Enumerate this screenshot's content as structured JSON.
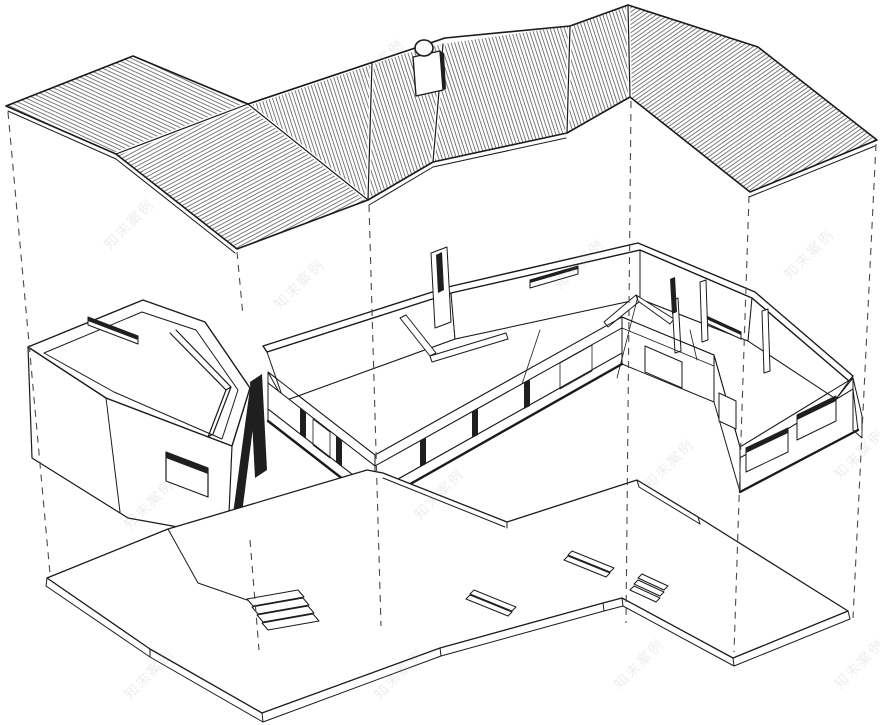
{
  "meta": {
    "description": "Exploded axonometric line drawing of an angled single-storey house: folded roof plate, floor-plan level and ground slab linked by dashed projection lines",
    "background": "#ffffff",
    "ink": "#1a1a1a",
    "hatch_color": "#555555",
    "dash_color": "#4a4a4a"
  },
  "watermark": {
    "text": "知末案例"
  },
  "levels": {
    "roof": {
      "name": "folded roof plate",
      "facet_count": 7,
      "has_chimney": true
    },
    "floor": {
      "name": "floor plan level",
      "parts": [
        "garage wing",
        "main floor"
      ],
      "clerestory_slits": 3
    },
    "base": {
      "name": "ground slab",
      "stairs": 2,
      "ramps": 3
    }
  },
  "projection_lines": {
    "count": 7,
    "style": "dashed"
  }
}
